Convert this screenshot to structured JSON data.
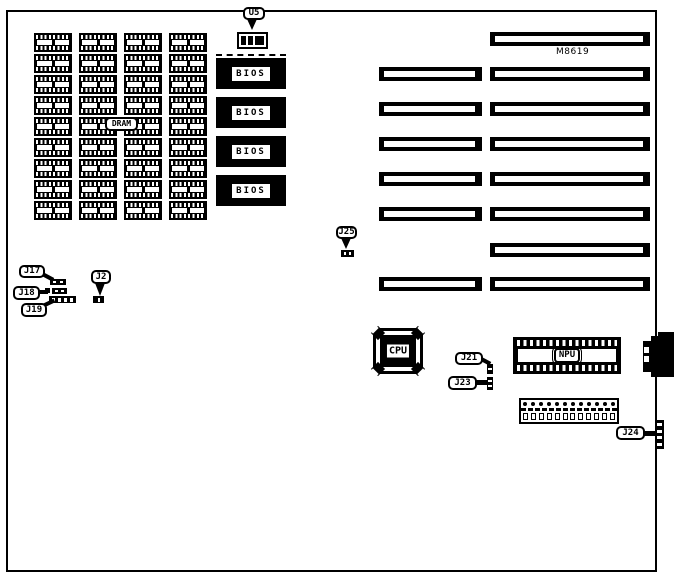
{
  "diagram": {
    "board_id": "M8619",
    "callouts": {
      "u5": "U5",
      "dram": "DRAM",
      "bios": "BIOS",
      "j25": "J25",
      "j17": "J17",
      "j18": "J18",
      "j19": "J19",
      "j2": "J2",
      "cpu": "CPU",
      "j21": "J21",
      "j23": "J23",
      "npu": "NPU",
      "j24": "J24"
    },
    "dram_grid": {
      "columns": 4,
      "rows": 9
    },
    "bios_chips": 4,
    "expansion_slots": {
      "left_column": 6,
      "right_column": 8
    },
    "power_connector_pins": 12
  },
  "colors": {
    "ink": "#000000",
    "paper": "#ffffff"
  }
}
